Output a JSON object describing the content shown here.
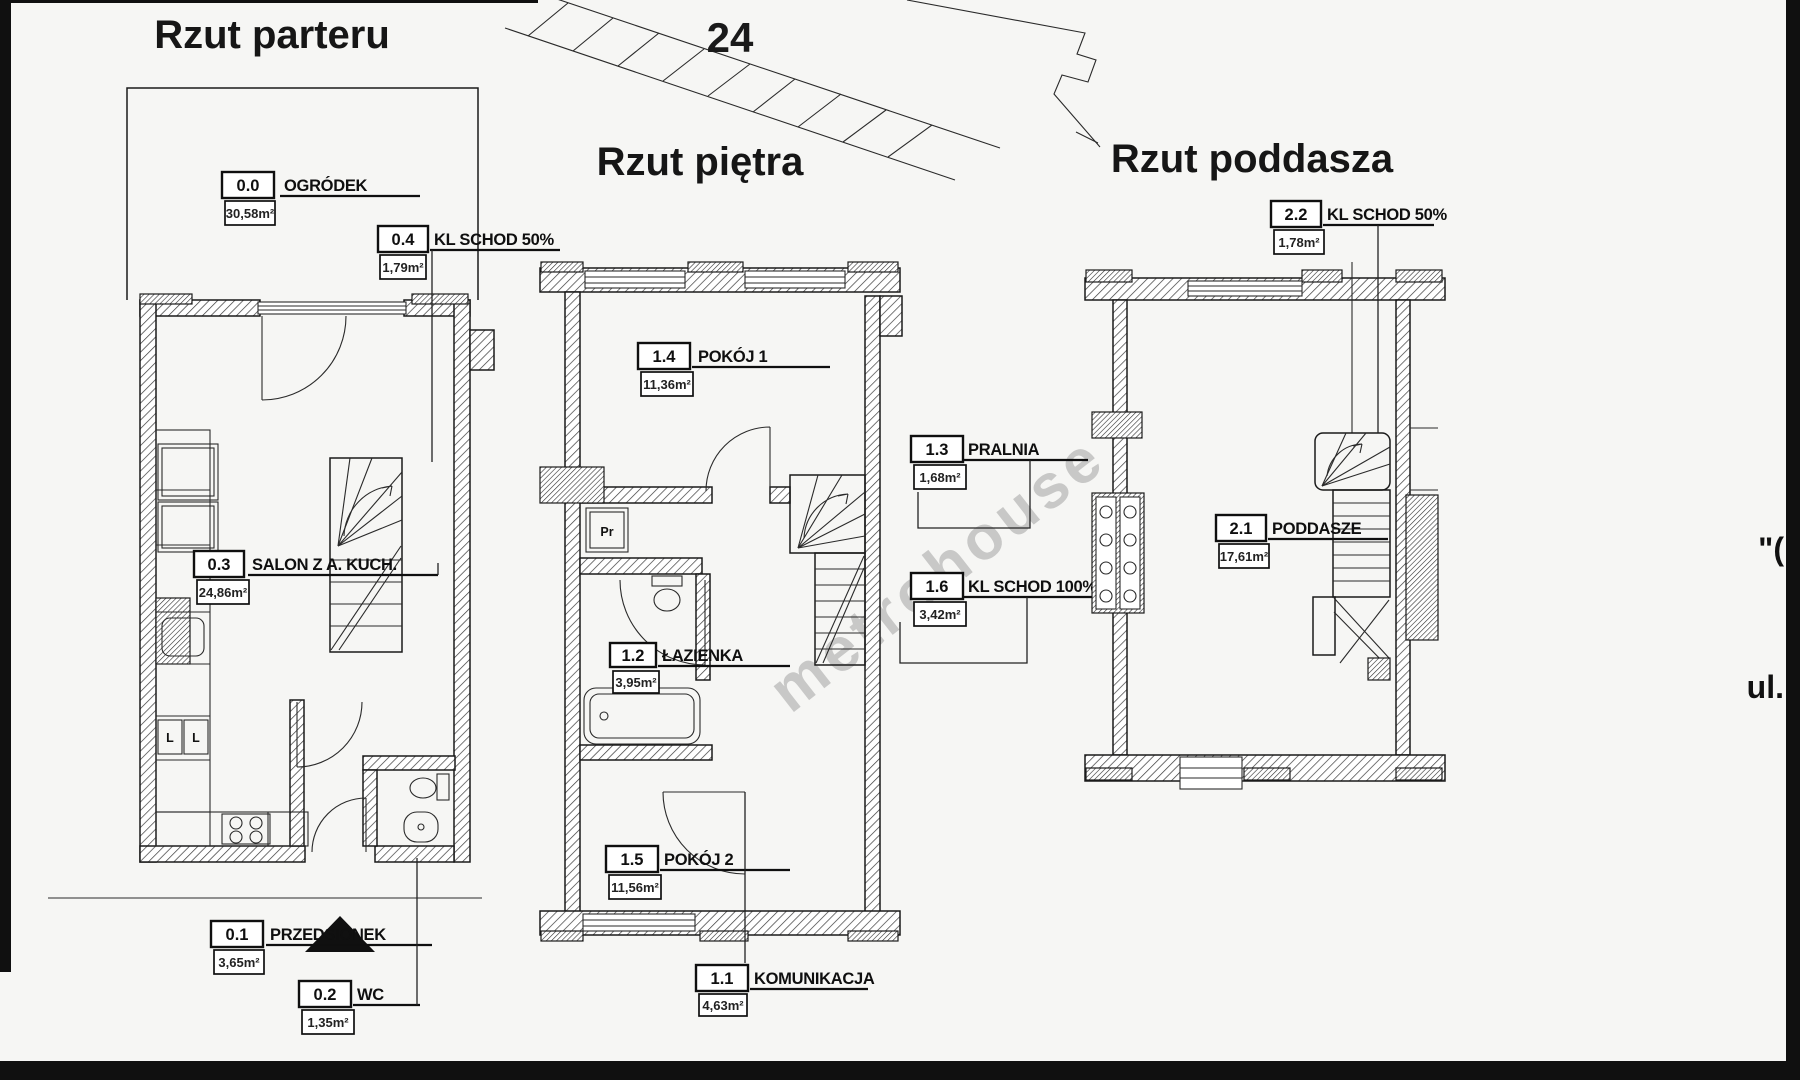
{
  "scan": {
    "site_parcel_number": "24",
    "watermark": "metrohouse",
    "right_margin_top": "\"(",
    "right_margin_street": "ul."
  },
  "plans": {
    "parter": {
      "title": "Rzut parteru",
      "rooms": {
        "ogrodek": {
          "no": "0.0",
          "name": "OGRÓDEK",
          "area": "30,58m²"
        },
        "kl_schod": {
          "no": "0.4",
          "name": "KL SCHOD 50%",
          "area": "1,79m²"
        },
        "salon": {
          "no": "0.3",
          "name": "SALON Z A. KUCH.",
          "area": "24,86m²"
        },
        "przedsionek": {
          "no": "0.1",
          "name": "PRZEDSIONEK",
          "area": "3,65m²"
        },
        "wc": {
          "no": "0.2",
          "name": "WC",
          "area": "1,35m²"
        }
      },
      "symbols": {
        "cabinet_left": "L",
        "cabinet_right": "L"
      }
    },
    "pietro": {
      "title": "Rzut piętra",
      "rooms": {
        "pokoj1": {
          "no": "1.4",
          "name": "POKÓJ 1",
          "area": "11,36m²"
        },
        "pralnia": {
          "no": "1.3",
          "name": "PRALNIA",
          "area": "1,68m²"
        },
        "kl_schod": {
          "no": "1.6",
          "name": "KL SCHOD 100%",
          "area": "3,42m²"
        },
        "lazienka": {
          "no": "1.2",
          "name": "ŁAZIENKA",
          "area": "3,95m²"
        },
        "pokoj2": {
          "no": "1.5",
          "name": "POKÓJ 2",
          "area": "11,56m²"
        },
        "komunikacja": {
          "no": "1.1",
          "name": "KOMUNIKACJA",
          "area": "4,63m²"
        }
      },
      "symbols": {
        "washer": "Pr"
      }
    },
    "poddasze": {
      "title": "Rzut poddasza",
      "rooms": {
        "kl_schod": {
          "no": "2.2",
          "name": "KL SCHOD 50%",
          "area": "1,78m²"
        },
        "poddasze": {
          "no": "2.1",
          "name": "PODDASZE",
          "area": "17,61m²"
        }
      }
    }
  }
}
